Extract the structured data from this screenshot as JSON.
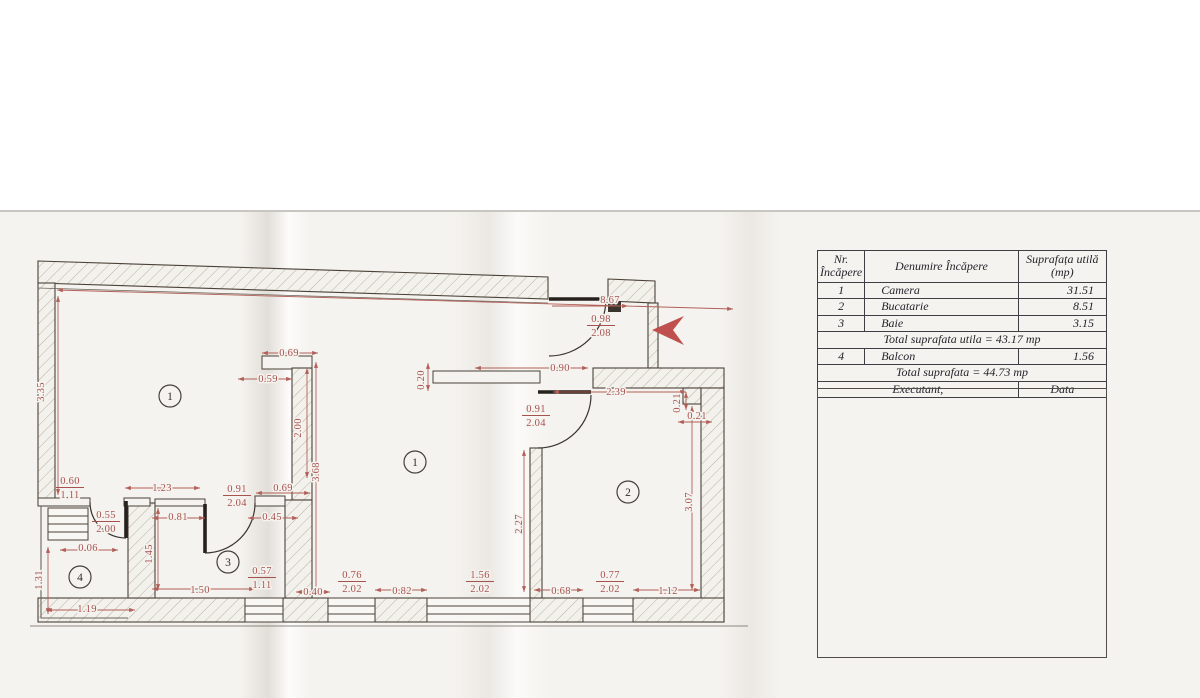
{
  "table": {
    "headers": [
      "Nr.\nÎncăpere",
      "Denumire Încăpere",
      "Suprafața utilă\n(mp)"
    ],
    "rows": [
      {
        "nr": "1",
        "name": "Camera",
        "area": "31.51"
      },
      {
        "nr": "2",
        "name": "Bucatarie",
        "area": "8.51"
      },
      {
        "nr": "3",
        "name": "Baie",
        "area": "3.15"
      }
    ],
    "total_usable": "Total suprafata utila = 43.17 mp",
    "row_balcony": {
      "nr": "4",
      "name": "Balcon",
      "area": "1.56"
    },
    "total_all": "Total suprafata = 44.73 mp",
    "footer": {
      "executant": "Executant,",
      "data": "Data"
    }
  },
  "plan": {
    "colors": {
      "dimension": "#a8524e",
      "wall": "#4a4238",
      "arrow": "#c0504d",
      "paper": "#f5f3ef"
    },
    "room_badges": [
      {
        "n": "1",
        "x": 170,
        "y": 396
      },
      {
        "n": "1",
        "x": 415,
        "y": 462
      },
      {
        "n": "2",
        "x": 628,
        "y": 492
      },
      {
        "n": "3",
        "x": 228,
        "y": 562
      },
      {
        "n": "4",
        "x": 80,
        "y": 577
      }
    ],
    "dimension_labels": [
      {
        "t": "8.67",
        "x": 610,
        "y": 303
      },
      {
        "t": "3.35",
        "x": 44,
        "y": 392,
        "r": -90
      },
      {
        "t": "0.69",
        "x": 289,
        "y": 356
      },
      {
        "t": "0.59",
        "x": 268,
        "y": 382
      },
      {
        "t": "2.00",
        "x": 301,
        "y": 428,
        "r": -90
      },
      {
        "t": "3.68",
        "x": 319,
        "y": 472,
        "r": -90
      },
      {
        "t": "0.90",
        "x": 560,
        "y": 371
      },
      {
        "t": "0.20",
        "x": 424,
        "y": 380,
        "r": -90
      },
      {
        "t": "2.39",
        "x": 616,
        "y": 395
      },
      {
        "t": "0.21",
        "x": 680,
        "y": 403,
        "r": -90
      },
      {
        "t": "0.21",
        "x": 697,
        "y": 419
      },
      {
        "t": "2.27",
        "x": 522,
        "y": 524,
        "r": -90
      },
      {
        "t": "3.07",
        "x": 692,
        "y": 502,
        "r": -90
      },
      {
        "t": "1.23",
        "x": 162,
        "y": 491
      },
      {
        "t": "0.69",
        "x": 283,
        "y": 491
      },
      {
        "t": "0.81",
        "x": 178,
        "y": 520
      },
      {
        "t": "0.45",
        "x": 272,
        "y": 520
      },
      {
        "t": "0.06",
        "x": 88,
        "y": 551
      },
      {
        "t": "1.45",
        "x": 152,
        "y": 554,
        "r": -90
      },
      {
        "t": "1.31",
        "x": 42,
        "y": 580,
        "r": -90
      },
      {
        "t": "1.50",
        "x": 200,
        "y": 593
      },
      {
        "t": "0.40",
        "x": 313,
        "y": 595
      },
      {
        "t": "0.82",
        "x": 402,
        "y": 594
      },
      {
        "t": "0.68",
        "x": 561,
        "y": 594
      },
      {
        "t": "1.12",
        "x": 668,
        "y": 594
      },
      {
        "t": "1.19",
        "x": 87,
        "y": 612
      }
    ],
    "dimension_fractions": [
      {
        "t": "0.98",
        "b": "2.08",
        "x": 601,
        "y": 322
      },
      {
        "t": "0.91",
        "b": "2.04",
        "x": 536,
        "y": 412
      },
      {
        "t": "0.60",
        "b": "1.11",
        "x": 70,
        "y": 484
      },
      {
        "t": "0.91",
        "b": "2.04",
        "x": 237,
        "y": 492
      },
      {
        "t": "0.55",
        "b": "2.00",
        "x": 106,
        "y": 518
      },
      {
        "t": "0.57",
        "b": "1.11",
        "x": 262,
        "y": 574
      },
      {
        "t": "0.76",
        "b": "2.02",
        "x": 352,
        "y": 578
      },
      {
        "t": "1.56",
        "b": "2.02",
        "x": 480,
        "y": 578
      },
      {
        "t": "0.77",
        "b": "2.02",
        "x": 610,
        "y": 578
      }
    ]
  }
}
